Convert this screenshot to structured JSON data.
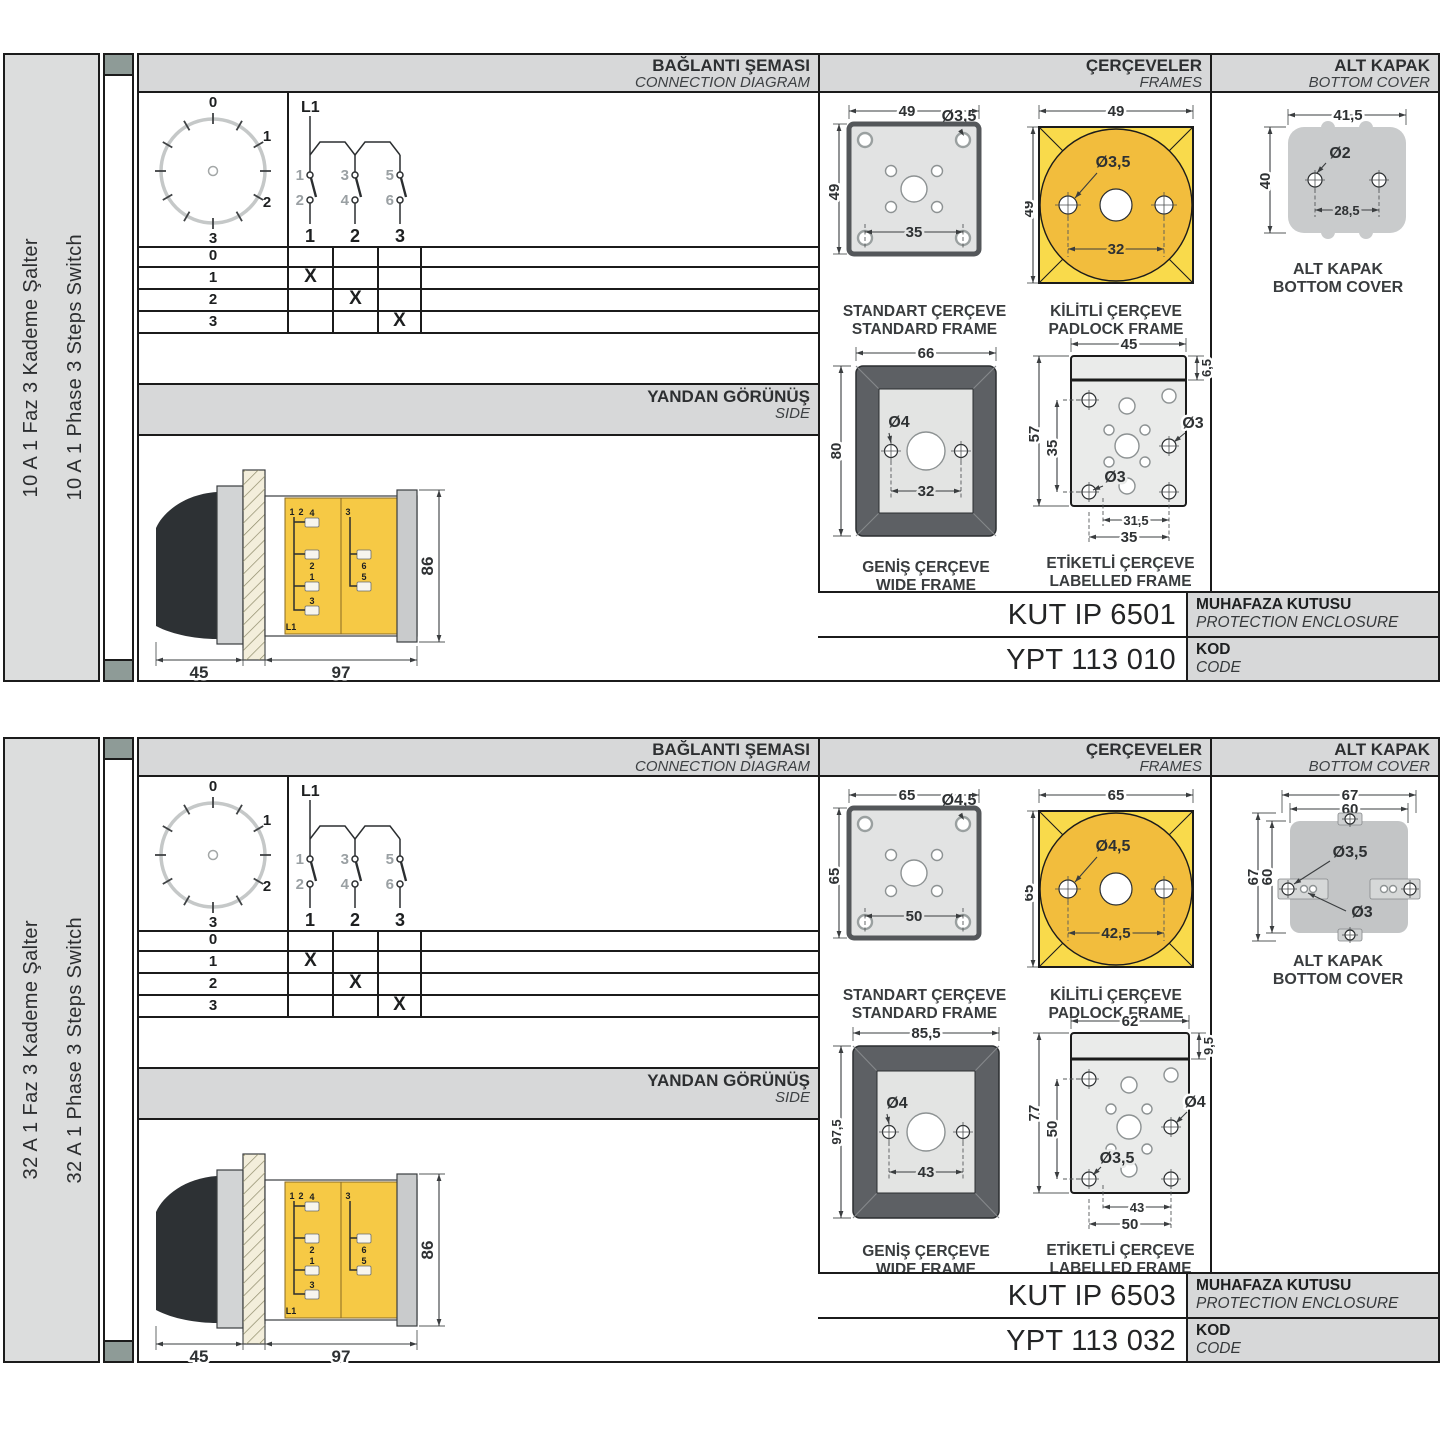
{
  "sections": [
    {
      "side_label_tr": "10 A 1 Faz 3 Kademe Şalter",
      "side_label_en": "10 A 1 Phase 3 Steps Switch",
      "headers": {
        "connection_tr": "BAĞLANTI ŞEMASI",
        "connection_en": "CONNECTION DIAGRAM",
        "frames_tr": "ÇERÇEVELER",
        "frames_en": "FRAMES",
        "cover_tr": "ALT KAPAK",
        "cover_en": "BOTTOM COVER"
      },
      "dial": {
        "p0": "0",
        "p1": "1",
        "p2": "2",
        "p3": "3"
      },
      "contact": {
        "phase": "L1",
        "top": [
          "1",
          "3",
          "5"
        ],
        "bottom": [
          "2",
          "4",
          "6"
        ],
        "poles": [
          "1",
          "2",
          "3"
        ]
      },
      "table": {
        "rows": [
          {
            "label": "0",
            "c1": "",
            "c2": "",
            "c3": ""
          },
          {
            "label": "1",
            "c1": "X",
            "c2": "",
            "c3": ""
          },
          {
            "label": "2",
            "c1": "",
            "c2": "X",
            "c3": ""
          },
          {
            "label": "3",
            "c1": "",
            "c2": "",
            "c3": "X"
          }
        ]
      },
      "side_view": {
        "title_tr": "YANDAN GÖRÜNÜŞ",
        "title_en": "SIDE",
        "dim_front": "45",
        "dim_body": "97",
        "dim_height": "86",
        "terminals": [
          "1",
          "2",
          "4",
          "2",
          "1",
          "3",
          "L1",
          "3",
          "6",
          "5"
        ]
      },
      "frames": {
        "standard": {
          "title_tr": "STANDART ÇERÇEVE",
          "title_en": "STANDARD FRAME",
          "w": "49",
          "h": "49",
          "hole": "Ø3,5",
          "spacing": "35"
        },
        "padlock": {
          "title_tr": "KİLİTLİ ÇERÇEVE",
          "title_en": "PADLOCK FRAME",
          "w": "49",
          "h": "49",
          "hole": "Ø3,5",
          "spacing": "32"
        },
        "wide": {
          "title_tr": "GENİŞ ÇERÇEVE",
          "title_en": "WIDE FRAME",
          "w": "66",
          "h": "80",
          "hole": "Ø4",
          "spacing": "32"
        },
        "labelled": {
          "title_tr": "ETİKETLİ ÇERÇEVE",
          "title_en": "LABELLED FRAME",
          "w": "45",
          "strip": "6,5",
          "h": "57",
          "inner_h": "35",
          "hole_top": "Ø3",
          "hole_bottom": "Ø3",
          "spacing_inner": "31,5",
          "spacing_outer": "35"
        }
      },
      "cover": {
        "title_tr": "ALT KAPAK",
        "title_en": "BOTTOM COVER",
        "w": "41,5",
        "h": "40",
        "hole": "Ø2",
        "spacing": "28,5"
      },
      "enclosure": {
        "value": "KUT IP 6501",
        "label_tr": "MUHAFAZA KUTUSU",
        "label_en": "PROTECTION ENCLOSURE"
      },
      "code": {
        "value": "YPT 113 010",
        "label_tr": "KOD",
        "label_en": "CODE"
      }
    },
    {
      "side_label_tr": "32 A 1 Faz 3 Kademe Şalter",
      "side_label_en": "32 A 1 Phase 3 Steps Switch",
      "headers": {
        "connection_tr": "BAĞLANTI ŞEMASI",
        "connection_en": "CONNECTION DIAGRAM",
        "frames_tr": "ÇERÇEVELER",
        "frames_en": "FRAMES",
        "cover_tr": "ALT KAPAK",
        "cover_en": "BOTTOM COVER"
      },
      "dial": {
        "p0": "0",
        "p1": "1",
        "p2": "2",
        "p3": "3"
      },
      "contact": {
        "phase": "L1",
        "top": [
          "1",
          "3",
          "5"
        ],
        "bottom": [
          "2",
          "4",
          "6"
        ],
        "poles": [
          "1",
          "2",
          "3"
        ]
      },
      "table": {
        "rows": [
          {
            "label": "0",
            "c1": "",
            "c2": "",
            "c3": ""
          },
          {
            "label": "1",
            "c1": "X",
            "c2": "",
            "c3": ""
          },
          {
            "label": "2",
            "c1": "",
            "c2": "X",
            "c3": ""
          },
          {
            "label": "3",
            "c1": "",
            "c2": "",
            "c3": "X"
          }
        ]
      },
      "side_view": {
        "title_tr": "YANDAN GÖRÜNÜŞ",
        "title_en": "SIDE",
        "dim_front": "45",
        "dim_body": "97",
        "dim_height": "86",
        "terminals": [
          "1",
          "2",
          "4",
          "2",
          "1",
          "3",
          "L1",
          "3",
          "6",
          "5"
        ]
      },
      "frames": {
        "standard": {
          "title_tr": "STANDART ÇERÇEVE",
          "title_en": "STANDARD FRAME",
          "w": "65",
          "h": "65",
          "hole": "Ø4,5",
          "spacing": "50"
        },
        "padlock": {
          "title_tr": "KİLİTLİ ÇERÇEVE",
          "title_en": "PADLOCK FRAME",
          "w": "65",
          "h": "65",
          "hole": "Ø4,5",
          "spacing": "42,5"
        },
        "wide": {
          "title_tr": "GENİŞ ÇERÇEVE",
          "title_en": "WIDE FRAME",
          "w": "85,5",
          "h": "97,5",
          "hole": "Ø4",
          "spacing": "43"
        },
        "labelled": {
          "title_tr": "ETİKETLİ ÇERÇEVE",
          "title_en": "LABELLED FRAME",
          "w": "62",
          "strip": "9,5",
          "h": "77",
          "inner_h": "50",
          "hole_top": "Ø4",
          "hole_bottom": "Ø3,5",
          "spacing_inner": "43",
          "spacing_outer": "50"
        }
      },
      "cover": {
        "title_tr": "ALT KAPAK",
        "title_en": "BOTTOM COVER",
        "w_outer": "67",
        "w_inner": "60",
        "h_outer": "67",
        "h_inner": "60",
        "hole_big": "Ø3,5",
        "hole_small": "Ø3"
      },
      "enclosure": {
        "value": "KUT IP 6503",
        "label_tr": "MUHAFAZA KUTUSU",
        "label_en": "PROTECTION ENCLOSURE"
      },
      "code": {
        "value": "YPT 113 032",
        "label_tr": "KOD",
        "label_en": "CODE"
      }
    }
  ]
}
